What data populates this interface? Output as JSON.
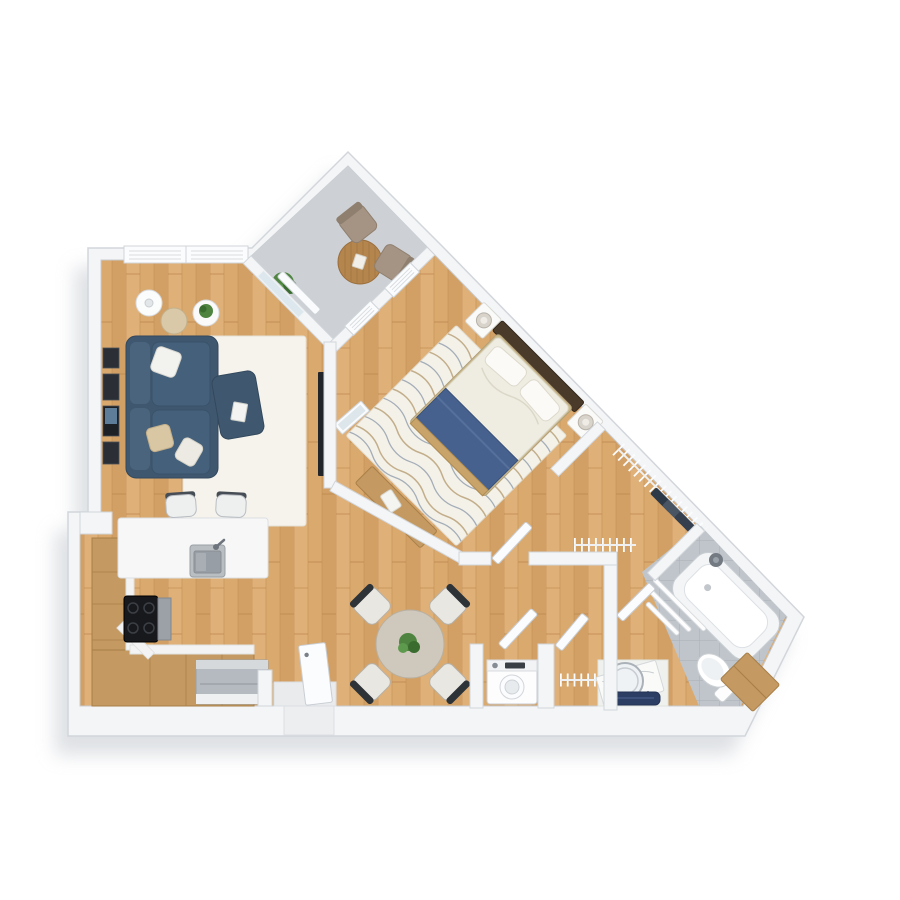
{
  "title": "3D top-down floor plan render – one-bedroom apartment with balcony",
  "plan_type": "architectural floor plan (3D render, no text labels)",
  "palette": {
    "background": "#ffffff",
    "wall": "#f4f5f7",
    "wall_edge": "#d2d6db",
    "shadow": "#c3c8cf",
    "wood_floor": "#d9a96e",
    "wood_plank_dark": "#c08e52",
    "balcony_floor": "#cdd1d5",
    "bath_tile": "#bfc5ca",
    "sofa_navy": "#3f586f",
    "blanket_blue": "#47618e",
    "bath_mat_navy": "#2c3e63",
    "furniture_wood": "#c49a62",
    "balcony_table_wood": "#b5854e",
    "rug_cream": "#f5f3ec",
    "taupe_chair": "#a59484",
    "plant_green": "#4e8440",
    "appliance_gray": "#b5bac0",
    "tv_black": "#22262b",
    "dining_table_taupe": "#cfc8bc",
    "counter_white": "#f6f7f6"
  },
  "rooms": [
    {
      "id": "living-room",
      "name": "Living room",
      "furniture": [
        "navy sofa with pillows",
        "navy ottoman with book",
        "cream area rug",
        "wall TV",
        "gallery picture frames",
        "floor lamp",
        "tan side table",
        "white side table with plant",
        "double window on top wall"
      ]
    },
    {
      "id": "balcony",
      "name": "Balcony (diagonal)",
      "furniture": [
        "round wooden bistro table",
        "2 taupe chairs",
        "potted plant",
        "glass balcony door",
        "window wall to bedroom"
      ]
    },
    {
      "id": "bedroom",
      "name": "Bedroom (rotated 45°)",
      "furniture": [
        "double bed with blue foot blanket and dark headboard",
        "2 white nightstands with lamps",
        "wavy-pattern cream rug",
        "wooden bench",
        "leaning mirror",
        "door to hallway"
      ]
    },
    {
      "id": "walk-in-closet",
      "name": "Walk-in closet",
      "furniture": [
        "hanging rail with hangers",
        "dark clothes on rail"
      ]
    },
    {
      "id": "hallway-dining",
      "name": "Hall / dining area",
      "furniture": [
        "round dining table with plant",
        "4 chairs",
        "open coat rail",
        "entrance door (ajar)"
      ]
    },
    {
      "id": "kitchen",
      "name": "Kitchen (U-shape)",
      "furniture": [
        "wooden cabinet runs",
        "white peninsula counter",
        "stainless sink with faucet",
        "black cooktop with oven",
        "gray dishwasher",
        "2 bar stools"
      ]
    },
    {
      "id": "utility-closets",
      "name": "Utility closets",
      "furniture": [
        "washing machine",
        "hanging rail",
        "2 open closet doors"
      ]
    },
    {
      "id": "bathroom",
      "name": "Bathroom",
      "furniture": [
        "corner bathtub/shower on gray tile",
        "shower head",
        "glass screen slats",
        "toilet",
        "wooden cabinet",
        "vanity with marble counter",
        "round mirror",
        "navy bath mat"
      ]
    }
  ],
  "counts": {
    "dining_chairs": 4,
    "balcony_chairs": 2,
    "bar_stools": 2,
    "nightstands": 2,
    "doors_open": 6
  }
}
